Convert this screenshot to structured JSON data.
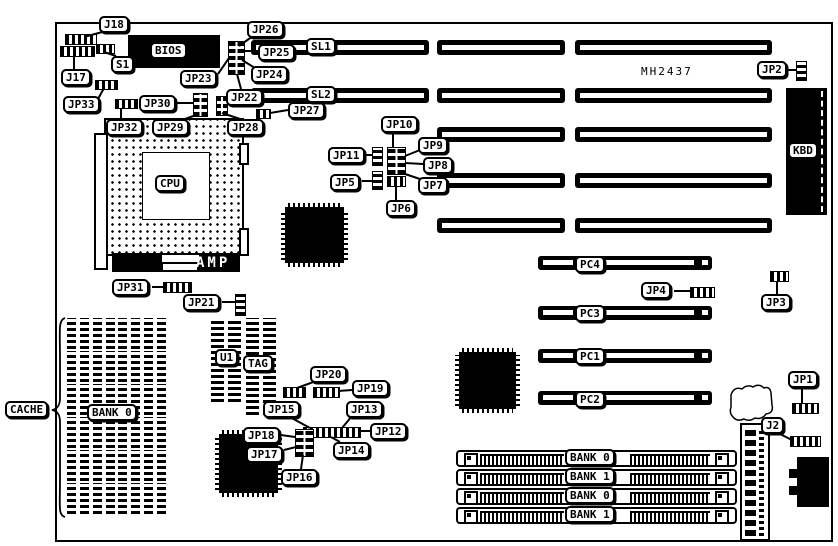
{
  "figure": {
    "kind": "motherboard jumper location diagram",
    "board_model": "MH2437"
  },
  "texts": {
    "model": "MH2437",
    "amp": "AMP"
  },
  "callouts": [
    {
      "id": "J18",
      "t": "J18",
      "x": 99,
      "y": 16,
      "line": [
        106,
        31,
        84,
        37
      ]
    },
    {
      "id": "J17",
      "t": "J17",
      "x": 61,
      "y": 69,
      "line": [
        74,
        69,
        74,
        57
      ]
    },
    {
      "id": "S1",
      "t": "S1",
      "x": 111,
      "y": 56,
      "line": [
        116,
        56,
        104,
        52
      ]
    },
    {
      "id": "JP33",
      "t": "JP33",
      "x": 63,
      "y": 96,
      "line": [
        98,
        99,
        104,
        88
      ]
    },
    {
      "id": "JP30",
      "t": "JP30",
      "x": 139,
      "y": 95,
      "line": [
        176,
        103,
        193,
        103
      ]
    },
    {
      "id": "JP32",
      "t": "JP32",
      "x": 106,
      "y": 119,
      "line": [
        121,
        119,
        121,
        108
      ]
    },
    {
      "id": "JP29",
      "t": "JP29",
      "x": 152,
      "y": 119,
      "line": [
        185,
        119,
        199,
        114
      ]
    },
    {
      "id": "JP28",
      "t": "JP28",
      "x": 227,
      "y": 119,
      "line": [
        240,
        119,
        222,
        113
      ]
    },
    {
      "id": "JP23",
      "t": "JP23",
      "x": 180,
      "y": 70,
      "line": [
        218,
        74,
        229,
        58
      ]
    },
    {
      "id": "JP26",
      "t": "JP26",
      "x": 247,
      "y": 21,
      "line": [
        253,
        36,
        239,
        46
      ]
    },
    {
      "id": "JP25",
      "t": "JP25",
      "x": 258,
      "y": 44,
      "line": [
        258,
        51,
        244,
        51
      ]
    },
    {
      "id": "JP24",
      "t": "JP24",
      "x": 251,
      "y": 66,
      "line": [
        255,
        68,
        242,
        60
      ]
    },
    {
      "id": "JP22",
      "t": "JP22",
      "x": 226,
      "y": 89,
      "line": [
        241,
        89,
        237,
        74
      ]
    },
    {
      "id": "JP27",
      "t": "JP27",
      "x": 288,
      "y": 102,
      "line": [
        288,
        110,
        270,
        113
      ]
    },
    {
      "id": "SL1",
      "t": "SL1",
      "x": 306,
      "y": 38
    },
    {
      "id": "SL2",
      "t": "SL2",
      "x": 306,
      "y": 86
    },
    {
      "id": "JP2",
      "t": "JP2",
      "x": 757,
      "y": 61,
      "line": [
        786,
        70,
        797,
        70
      ]
    },
    {
      "id": "JP10",
      "t": "JP10",
      "x": 381,
      "y": 116,
      "line": [
        393,
        131,
        393,
        147
      ]
    },
    {
      "id": "JP11",
      "t": "JP11",
      "x": 328,
      "y": 147,
      "line": [
        364,
        155,
        373,
        155
      ]
    },
    {
      "id": "JP9",
      "t": "JP9",
      "x": 418,
      "y": 137,
      "line": [
        420,
        150,
        405,
        156
      ]
    },
    {
      "id": "JP8",
      "t": "JP8",
      "x": 423,
      "y": 157,
      "line": [
        423,
        164,
        405,
        163
      ]
    },
    {
      "id": "JP5",
      "t": "JP5",
      "x": 330,
      "y": 174,
      "line": [
        362,
        181,
        373,
        181
      ]
    },
    {
      "id": "JP7",
      "t": "JP7",
      "x": 418,
      "y": 177,
      "line": [
        420,
        179,
        405,
        174
      ]
    },
    {
      "id": "JP6",
      "t": "JP6",
      "x": 386,
      "y": 200,
      "line": [
        396,
        200,
        396,
        186
      ]
    },
    {
      "id": "JP31",
      "t": "JP31",
      "x": 112,
      "y": 279,
      "line": [
        152,
        287,
        163,
        287
      ]
    },
    {
      "id": "JP21",
      "t": "JP21",
      "x": 183,
      "y": 294,
      "line": [
        222,
        302,
        235,
        302
      ]
    },
    {
      "id": "CACHE",
      "t": "CACHE",
      "x": 5,
      "y": 401
    },
    {
      "id": "BANK0C",
      "t": "BANK 0",
      "x": 87,
      "y": 404
    },
    {
      "id": "U1",
      "t": "U1",
      "x": 215,
      "y": 349
    },
    {
      "id": "TAG",
      "t": "TAG",
      "x": 243,
      "y": 355
    },
    {
      "id": "JP20",
      "t": "JP20",
      "x": 310,
      "y": 366,
      "line": [
        316,
        381,
        297,
        388
      ]
    },
    {
      "id": "JP19",
      "t": "JP19",
      "x": 352,
      "y": 380,
      "line": [
        352,
        390,
        338,
        391
      ]
    },
    {
      "id": "JP15",
      "t": "JP15",
      "x": 263,
      "y": 401,
      "line": [
        288,
        416,
        310,
        428
      ]
    },
    {
      "id": "JP13",
      "t": "JP13",
      "x": 346,
      "y": 401,
      "line": [
        352,
        416,
        342,
        428
      ]
    },
    {
      "id": "JP12",
      "t": "JP12",
      "x": 370,
      "y": 423,
      "line": [
        370,
        431,
        358,
        431
      ]
    },
    {
      "id": "JP18",
      "t": "JP18",
      "x": 243,
      "y": 427,
      "line": [
        281,
        435,
        295,
        437
      ]
    },
    {
      "id": "JP17",
      "t": "JP17",
      "x": 246,
      "y": 446,
      "line": [
        284,
        450,
        296,
        447
      ]
    },
    {
      "id": "JP14",
      "t": "JP14",
      "x": 333,
      "y": 442,
      "line": [
        340,
        442,
        331,
        437
      ]
    },
    {
      "id": "JP16",
      "t": "JP16",
      "x": 281,
      "y": 469,
      "line": [
        301,
        469,
        303,
        455
      ]
    },
    {
      "id": "PC4",
      "t": "PC4",
      "x": 575,
      "y": 256
    },
    {
      "id": "JP4",
      "t": "JP4",
      "x": 641,
      "y": 282,
      "line": [
        674,
        291,
        691,
        291
      ]
    },
    {
      "id": "PC3",
      "t": "PC3",
      "x": 575,
      "y": 305
    },
    {
      "id": "JP3",
      "t": "JP3",
      "x": 761,
      "y": 294,
      "line": [
        777,
        294,
        777,
        281
      ]
    },
    {
      "id": "PC1",
      "t": "PC1",
      "x": 575,
      "y": 348
    },
    {
      "id": "PC2",
      "t": "PC2",
      "x": 575,
      "y": 391
    },
    {
      "id": "JP1",
      "t": "JP1",
      "x": 788,
      "y": 371,
      "line": [
        802,
        387,
        802,
        403
      ]
    },
    {
      "id": "J2",
      "t": "J2",
      "x": 761,
      "y": 417,
      "line": [
        778,
        433,
        792,
        440
      ]
    },
    {
      "id": "BIOS",
      "t": "BIOS",
      "x": 150,
      "y": 42
    },
    {
      "id": "CPU",
      "t": "CPU",
      "x": 155,
      "y": 175
    },
    {
      "id": "KBD",
      "t": "KBD",
      "x": 788,
      "y": 142
    },
    {
      "id": "BANK0A",
      "t": "BANK 0",
      "x": 565,
      "y": 449
    },
    {
      "id": "BANK1A",
      "t": "BANK 1",
      "x": 565,
      "y": 468
    },
    {
      "id": "BANK0B",
      "t": "BANK 0",
      "x": 565,
      "y": 487
    },
    {
      "id": "BANK1B",
      "t": "BANK 1",
      "x": 565,
      "y": 506
    }
  ],
  "geometry": {
    "board": {
      "x": 55,
      "y": 22,
      "w": 774,
      "h": 516
    },
    "isa_cols": {
      "A": [
        251,
        429
      ],
      "B": [
        437,
        565
      ],
      "C": [
        575,
        772
      ]
    },
    "isa_rows": [
      {
        "y": 40,
        "cols": [
          "A",
          "B",
          "C"
        ]
      },
      {
        "y": 88,
        "cols": [
          "A",
          "B",
          "C"
        ]
      },
      {
        "y": 127,
        "cols": [
          "B",
          "C"
        ]
      },
      {
        "y": 173,
        "cols": [
          "B",
          "C"
        ]
      },
      {
        "y": 218,
        "cols": [
          "B",
          "C"
        ]
      }
    ],
    "pci": {
      "x": 538,
      "w": 174,
      "h": 14,
      "rows": [
        256,
        306,
        349,
        391
      ]
    },
    "simm": {
      "x": 456,
      "w": 281,
      "h": 17,
      "rows": [
        450,
        469,
        488,
        507
      ]
    },
    "cache": {
      "cols": [
        67,
        93,
        118,
        144
      ],
      "w": 22,
      "rows": [
        318,
        351,
        384,
        417,
        450,
        483
      ],
      "h": 31
    },
    "dips": [
      {
        "x": 211,
        "y": 318,
        "w": 30,
        "h": 84
      },
      {
        "x": 246,
        "y": 318,
        "w": 30,
        "h": 97
      }
    ],
    "qfps": [
      {
        "x": 281,
        "y": 203,
        "w": 67,
        "h": 64
      },
      {
        "x": 455,
        "y": 348,
        "w": 65,
        "h": 65
      },
      {
        "x": 215,
        "y": 430,
        "w": 67,
        "h": 67
      }
    ],
    "jumpers": [
      {
        "id": "j18-jumper",
        "k": "h",
        "x": 65,
        "y": 34,
        "w": 30,
        "h": 9
      },
      {
        "id": "j17-jumper",
        "k": "h",
        "x": 60,
        "y": 46,
        "w": 33,
        "h": 9
      },
      {
        "id": "s1-switch",
        "k": "h",
        "x": 96,
        "y": 44,
        "w": 17,
        "h": 8
      },
      {
        "id": "jp33-jumper",
        "k": "h",
        "x": 95,
        "y": 80,
        "w": 21,
        "h": 8
      },
      {
        "id": "jp32-jumper",
        "k": "h",
        "x": 115,
        "y": 99,
        "w": 21,
        "h": 8
      },
      {
        "id": "jp30-jumper",
        "k": "g",
        "x": 193,
        "y": 93,
        "w": 13,
        "h": 22
      },
      {
        "id": "jp29-jumper",
        "k": "g",
        "x": 216,
        "y": 96,
        "w": 10,
        "h": 18
      },
      {
        "id": "jp23-jumper-block",
        "k": "g",
        "x": 228,
        "y": 41,
        "w": 15,
        "h": 32
      },
      {
        "id": "jp27-jumper",
        "k": "h",
        "x": 256,
        "y": 109,
        "w": 13,
        "h": 8
      },
      {
        "id": "jp2-jumper",
        "k": "v",
        "x": 796,
        "y": 61,
        "w": 9,
        "h": 18
      },
      {
        "id": "jp8-jumper-block",
        "k": "g",
        "x": 387,
        "y": 147,
        "w": 17,
        "h": 26
      },
      {
        "id": "jp7-jumper",
        "k": "h",
        "x": 387,
        "y": 176,
        "w": 17,
        "h": 9
      },
      {
        "id": "jp11-jumper",
        "k": "v",
        "x": 372,
        "y": 147,
        "w": 9,
        "h": 17
      },
      {
        "id": "jp5-jumper",
        "k": "v",
        "x": 372,
        "y": 171,
        "w": 9,
        "h": 17
      },
      {
        "id": "jp31-jumper",
        "k": "h",
        "x": 163,
        "y": 282,
        "w": 27,
        "h": 9
      },
      {
        "id": "jp21-jumper",
        "k": "v",
        "x": 235,
        "y": 294,
        "w": 9,
        "h": 20
      },
      {
        "id": "jp20-jumper",
        "k": "h",
        "x": 283,
        "y": 387,
        "w": 21,
        "h": 9
      },
      {
        "id": "jp19-jumper",
        "k": "h",
        "x": 313,
        "y": 387,
        "w": 25,
        "h": 9
      },
      {
        "id": "jp12-jumper-strip",
        "k": "h",
        "x": 303,
        "y": 427,
        "w": 56,
        "h": 9
      },
      {
        "id": "jp17-jumper-block",
        "k": "g",
        "x": 295,
        "y": 429,
        "w": 17,
        "h": 26
      },
      {
        "id": "jp4-jumper",
        "k": "h",
        "x": 690,
        "y": 287,
        "w": 23,
        "h": 9
      },
      {
        "id": "jp3-jumper",
        "k": "h",
        "x": 770,
        "y": 271,
        "w": 17,
        "h": 9
      },
      {
        "id": "jp1-jumper",
        "k": "h",
        "x": 792,
        "y": 403,
        "w": 25,
        "h": 9
      },
      {
        "id": "j2-jumper",
        "k": "h",
        "x": 790,
        "y": 436,
        "w": 29,
        "h": 9
      }
    ],
    "bios": {
      "x": 128,
      "y": 35,
      "w": 92,
      "h": 33
    },
    "cpu": {
      "x": 104,
      "y": 118,
      "w": 136,
      "h": 134,
      "inner": {
        "x": 142,
        "y": 152,
        "w": 66,
        "h": 66
      },
      "leftbar": {
        "x": 94,
        "y": 133,
        "w": 10,
        "h": 133
      },
      "tabs": [
        {
          "x": 239,
          "y": 143,
          "w": 6,
          "h": 18
        },
        {
          "x": 239,
          "y": 228,
          "w": 6,
          "h": 24
        }
      ]
    },
    "amp": {
      "x": 112,
      "y": 253,
      "w": 128,
      "h": 19,
      "white1": {
        "x": 162,
        "y": 255,
        "w": 37,
        "h": 7
      },
      "white2": {
        "x": 163,
        "y": 264,
        "w": 34,
        "h": 6
      },
      "text_x": 196,
      "text_y": 255
    },
    "kbd": {
      "x": 786,
      "y": 88,
      "w": 41,
      "h": 127
    },
    "powercon": {
      "x": 740,
      "y": 423,
      "w": 26,
      "h": 114
    },
    "atcon": {
      "x": 797,
      "y": 457,
      "w": 32,
      "h": 50,
      "tabs": [
        {
          "x": 789,
          "y": 469,
          "w": 9,
          "h": 9
        },
        {
          "x": 789,
          "y": 486,
          "w": 9,
          "h": 9
        }
      ]
    },
    "model_text": {
      "x": 641,
      "y": 65
    },
    "colors": {
      "ink": "#000000",
      "paper": "#ffffff"
    }
  }
}
